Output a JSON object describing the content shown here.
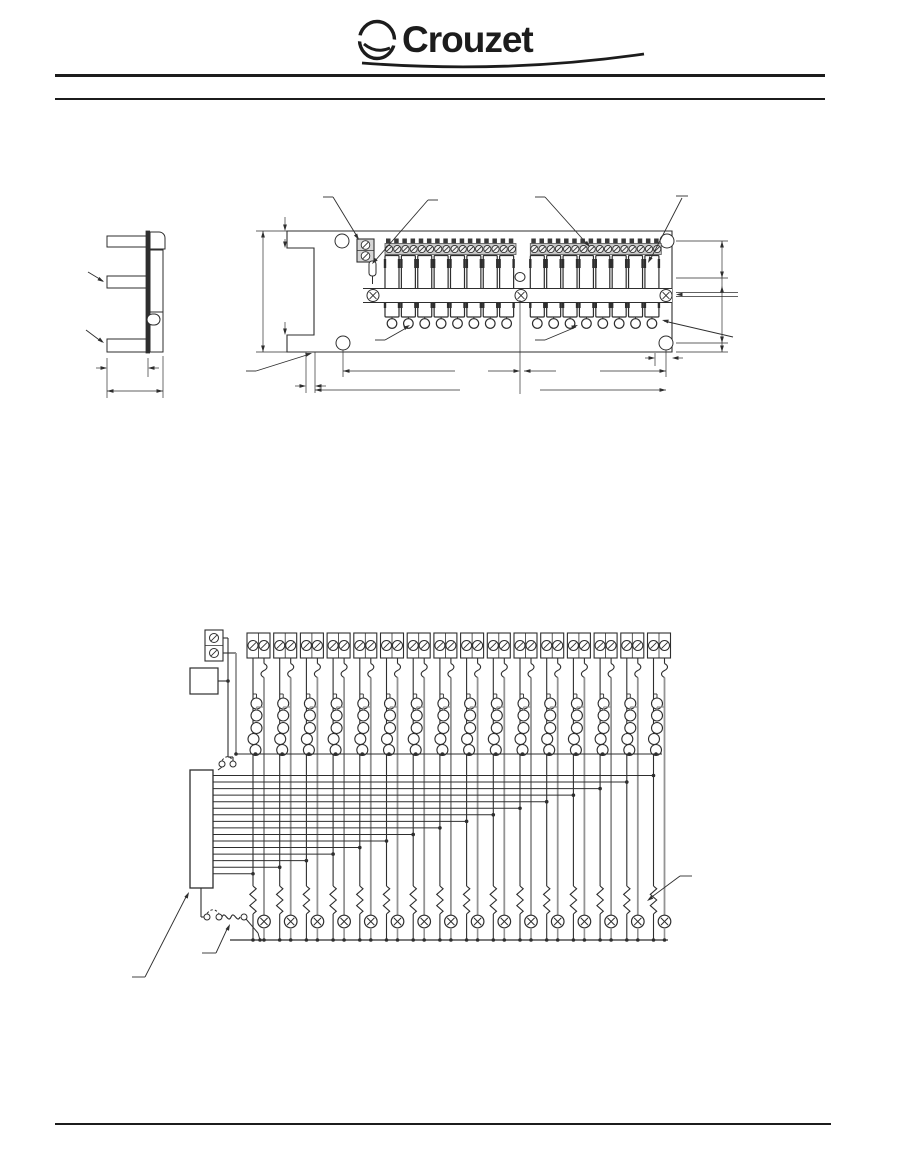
{
  "header": {
    "brand": "Crouzet"
  },
  "colors": {
    "ink": "#2e2e2e",
    "gray": "#949494",
    "strip": "#c8c8c8",
    "paper": "#ffffff",
    "rule": "#1c1c1c"
  },
  "dimension_drawing": {
    "side_view": {
      "mounting_flanges": 3
    },
    "front_view": {
      "banks": 2,
      "relays_per_bank": 8,
      "strip_screws_per_bank": 16,
      "mounting_holes": 4,
      "rail_screws": 3,
      "bottom_terminals_per_bank": 8
    }
  },
  "schematic": {
    "channels": 16,
    "bus_lines": 16,
    "terminal_screws_per_channel": 2,
    "socket_pins_per_channel": 5,
    "power_terminal_screws": 2,
    "jumper_links": 2,
    "per_channel": {
      "has_fuse": true,
      "has_resistor": true,
      "has_indicator_led": true
    }
  }
}
